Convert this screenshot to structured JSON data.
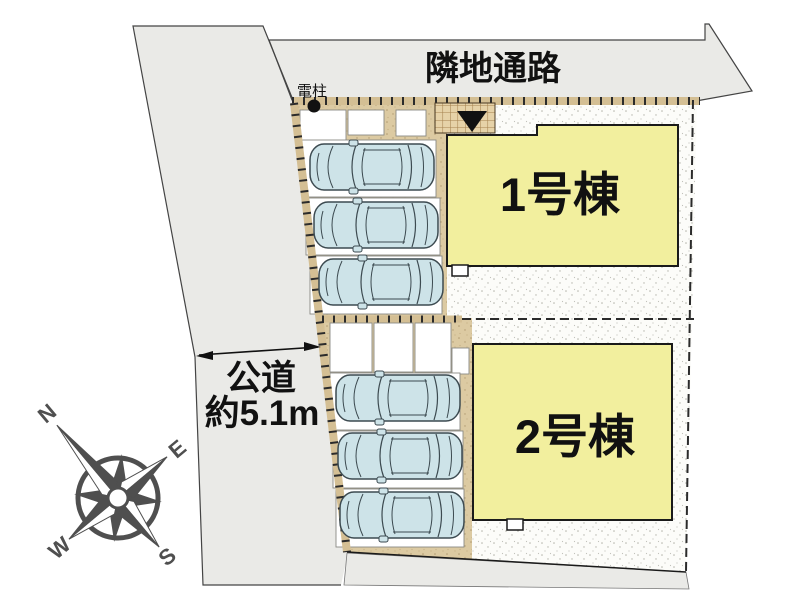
{
  "plan": {
    "neighbor_passage_label": "隣地通路",
    "utility_pole_label": "電柱",
    "road_label_line1": "公道",
    "road_label_line2": "約5.1m",
    "building1_label": "1号棟",
    "building2_label": "2号棟",
    "lot1_car_count": 3,
    "lot2_car_count": 3
  },
  "compass": {
    "north": "N",
    "east": "E",
    "south": "S",
    "west": "W",
    "rotation_deg": -40
  },
  "colors": {
    "road_gray": "#eaeae7",
    "building_yellow": "#f2ef9e",
    "parking_tan": "#dccaa2",
    "boundary_strip_tan": "#d4bf94",
    "car_body_blue": "#cde3e8",
    "entrance_grid_tan": "#e6d2a8",
    "compass_gray": "#4f4f4f"
  }
}
